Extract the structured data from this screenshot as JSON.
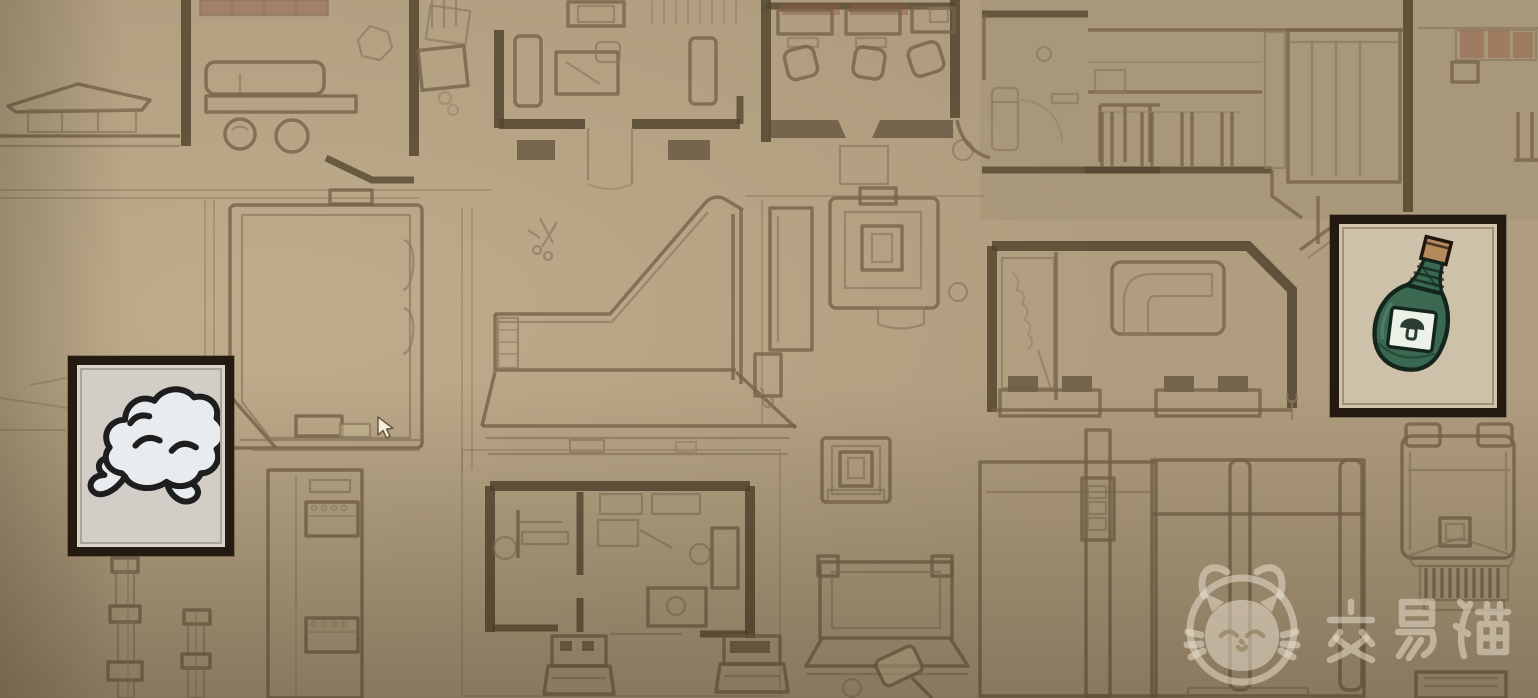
{
  "scene": {
    "description": "sepia hand-drawn top-down blueprint map of rooms with desks, counters, shelves, crates and a stage ramp",
    "palette": {
      "background": "#b09d7f",
      "thin_line": "#8b7960",
      "medium_line": "#75634a",
      "wall": "#54462f",
      "red_tint": "#8e5a44"
    }
  },
  "map_markers": [
    {
      "id": "smoke-item",
      "icon": "smoke-cloud-icon",
      "frame_color": "#241a10",
      "panel_color": "#d2cec7",
      "icon_colors": {
        "fill": "#e8ecee",
        "outline": "#1e1e1e"
      },
      "position": {
        "x": 68,
        "y": 356,
        "width": 166,
        "height": 200
      }
    },
    {
      "id": "potion-item",
      "icon": "green-bottle-mushroom-icon",
      "frame_color": "#1f1812",
      "panel_color": "#c9bda4",
      "icon_colors": {
        "bottle": "#3a6850",
        "cork": "#b5895b",
        "label": "#edf2e9",
        "outline": "#14261c"
      },
      "position": {
        "x": 1330,
        "y": 215,
        "width": 176,
        "height": 202
      }
    }
  ],
  "cursor": {
    "type": "arrow-pointer",
    "x": 378,
    "y": 418
  },
  "watermark": {
    "logo": "cat-face-logo",
    "text": "交易猫",
    "color": "#e8decc",
    "opacity": 0.55
  }
}
